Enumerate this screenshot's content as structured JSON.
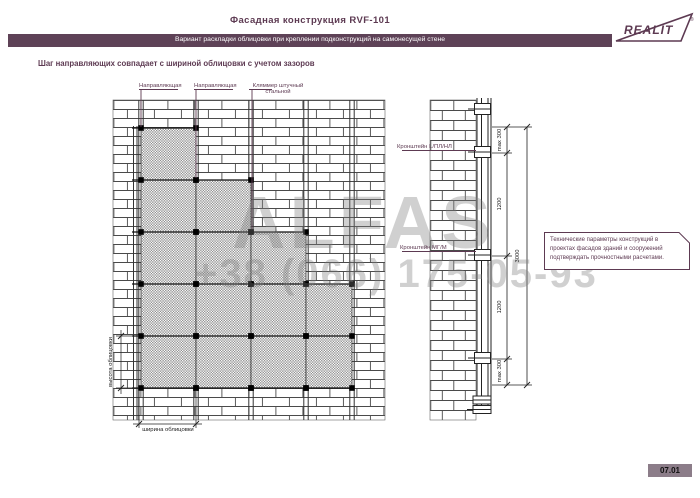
{
  "header": {
    "title": "Фасадная конструкция RVF-101",
    "banner": "Вариант раскладки облицовки при креплении подконструкций на самонесущей стене",
    "logo": "REALIT",
    "logo_reg": "®"
  },
  "subtitle": "Шаг направляющих совпадает с шириной облицовки с учетом зазоров",
  "front_view": {
    "labels": {
      "rail_1": "Направляющая",
      "rail_2": "Направляющая",
      "clamp": "Кляммер штучный\nстальной"
    },
    "dims": {
      "height": "высота облицовки",
      "width": "ширина облицовки"
    },
    "grid": {
      "row_y": [
        128,
        180,
        232,
        284,
        336
      ],
      "row_h": 52,
      "cols": [
        {
          "x": 141,
          "w": 55,
          "first_row": 0
        },
        {
          "x": 196,
          "w": 55,
          "first_row": 1
        },
        {
          "x": 251,
          "w": 55,
          "first_row": 2
        },
        {
          "x": 306,
          "w": 46,
          "first_row": 3
        }
      ]
    }
  },
  "side_view": {
    "labels": {
      "bracket_top": "Кронштейн L/ПЛ/НЛ",
      "bracket_mid": "Кронштейн МГ/М"
    },
    "dims": {
      "seg_1": "max 300",
      "seg_2": "1200",
      "seg_3": "1200",
      "seg_4": "max 300",
      "total": "3000"
    }
  },
  "note": {
    "text": "Технические параметры конструкций в проектах фасадов зданий и сооружений подтверждать прочностными расчетами."
  },
  "watermark": {
    "brand": "ALFAS",
    "phone": "+38 (066) 175-05-93"
  },
  "footer": {
    "page": "07.01"
  },
  "colors": {
    "maroon": "#5d3a52",
    "banner_bg": "#5e4257",
    "badge_bg": "#8c7d89"
  }
}
